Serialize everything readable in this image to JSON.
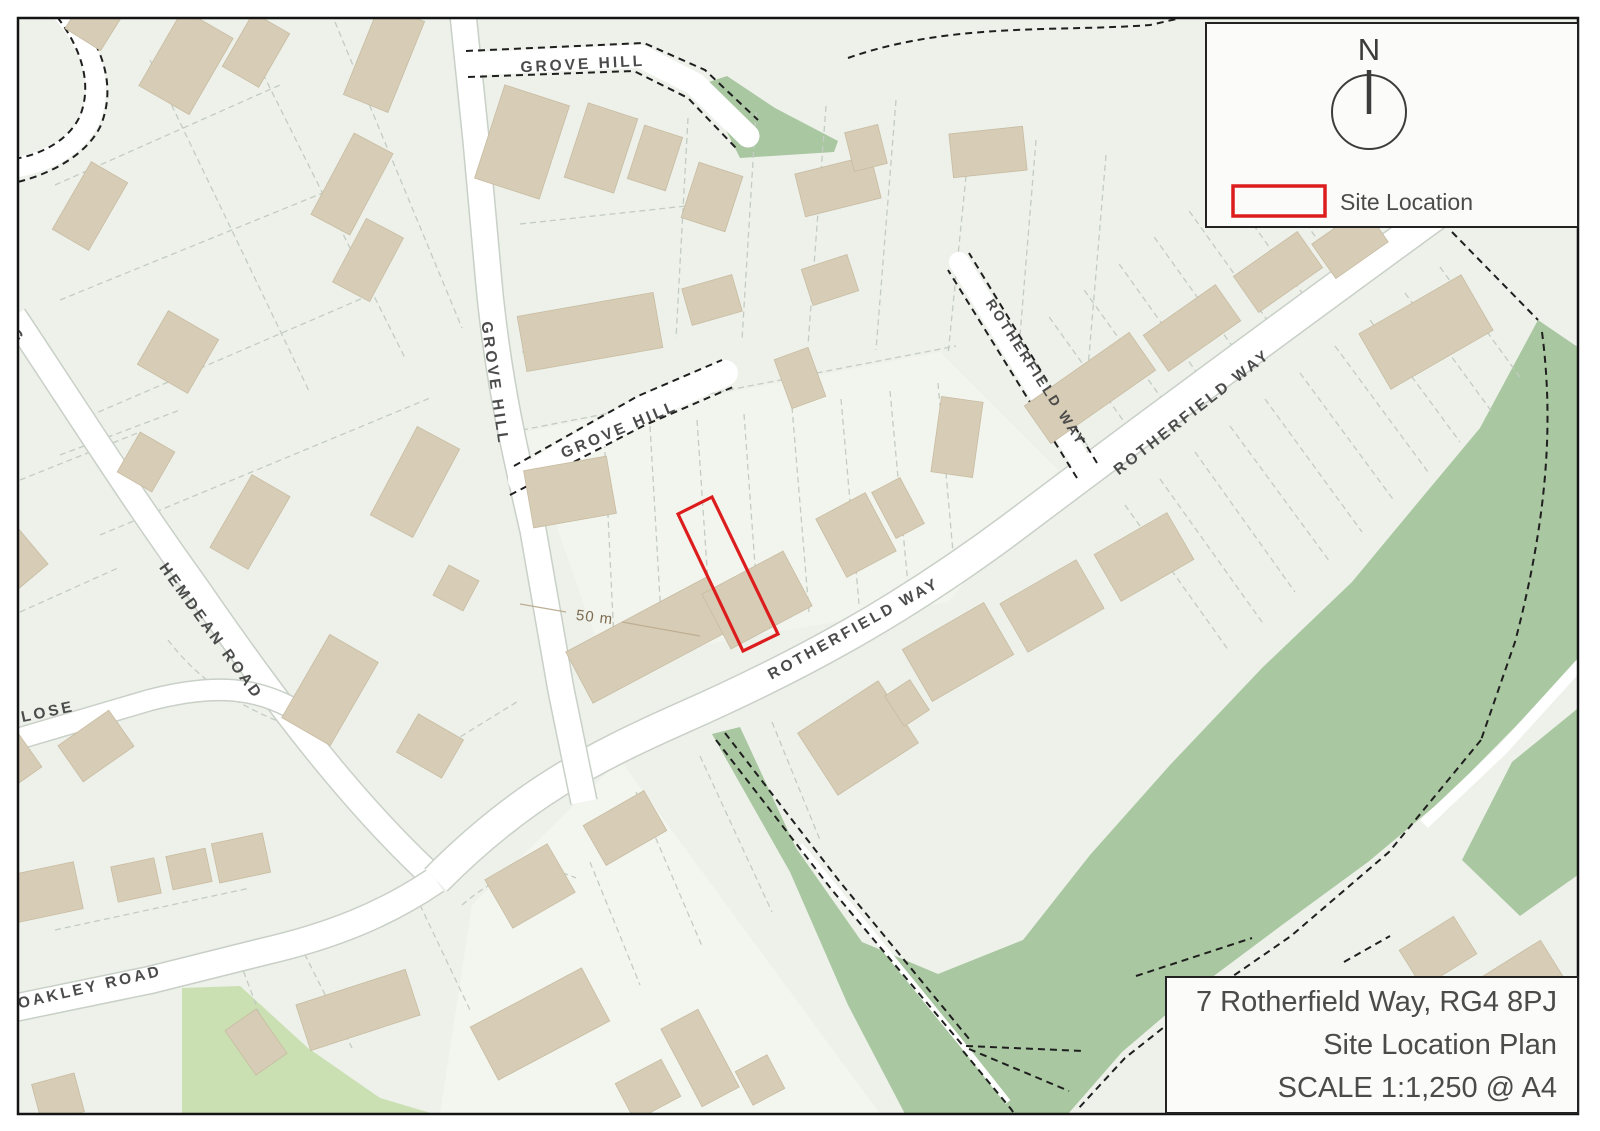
{
  "map": {
    "road_labels": {
      "grove_hill_top": "GROVE HILL",
      "grove_hill_vertical": "GROVE HILL",
      "grove_hill_diagonal": "GROVE HILL",
      "rotherfield_way_main": "ROTHERFIELD WAY",
      "rotherfield_way_upper": "ROTHERFIELD WAY",
      "rotherfield_way_branch": "ROTHERFIELD WAY",
      "hemdean_road": "HEMDEAN ROAD",
      "close_road": "CLOSE",
      "oakley_road": "OAKLEY ROAD",
      "edge_partial": "G"
    },
    "annotations": {
      "scale_marker": "50 m"
    },
    "colors": {
      "background": "#edf1ea",
      "road_fill": "#ffffff",
      "road_casing": "#c8d0c7",
      "building_fill": "#d7ccb5",
      "green_area": "#a9c7a0",
      "green_area_light": "#cadfb2",
      "site_boundary_red": "#dd1d1d",
      "label_gray": "#4b4b4b",
      "footpath_dash": "#1f1f1f",
      "scale_text": "#7d6b52"
    }
  },
  "legend": {
    "north_label": "N",
    "site_location_label": "Site Location"
  },
  "title_block": {
    "address_line": "7 Rotherfield Way, RG4 8PJ",
    "plan_type_line": "Site Location Plan",
    "scale_line": "SCALE 1:1,250 @ A4"
  }
}
